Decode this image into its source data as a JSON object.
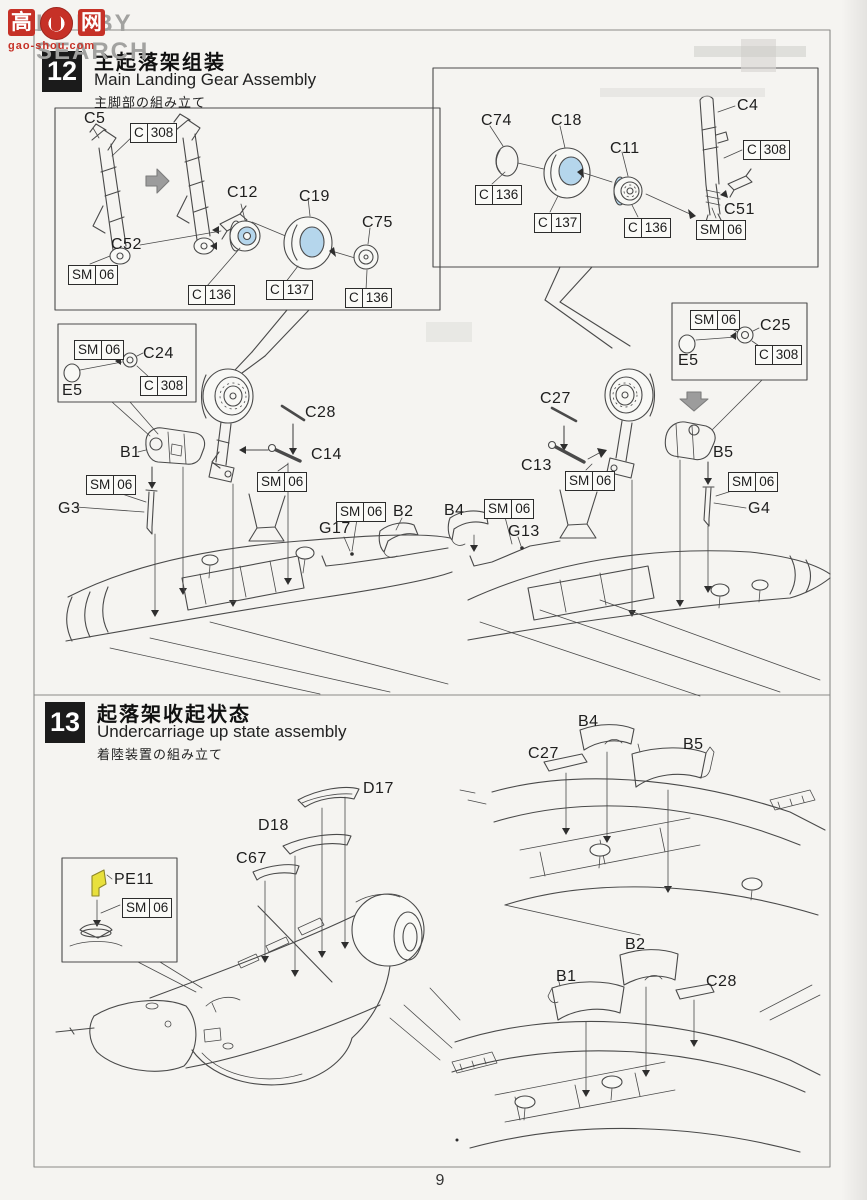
{
  "watermark": {
    "logo_left": "高",
    "logo_right": "网",
    "brand": "HOBBY SEARCH",
    "site": "gao-shou.com"
  },
  "page": {
    "number": "9"
  },
  "colors": {
    "highlight_blue": "#b5d6ec",
    "pe_yellow": "#e8e03c",
    "step_box_black": "#1b1b1b",
    "watermark_red": "#c63127",
    "line_gray": "#4a4a4a"
  },
  "steps": {
    "s12": {
      "number": "12",
      "title_cn": "主起落架组装",
      "title_en": "Main Landing Gear Assembly",
      "title_jp": "主脚部の組み立て"
    },
    "s13": {
      "number": "13",
      "title_cn": "起落架收起状态",
      "title_en": "Undercarriage up state assembly",
      "title_jp": "着陸装置の組み立て"
    }
  },
  "parts": {
    "b1": "B1",
    "b2": "B2",
    "b4": "B4",
    "b5": "B5",
    "c4": "C4",
    "c5": "C5",
    "c11": "C11",
    "c12": "C12",
    "c13": "C13",
    "c14": "C14",
    "c18": "C18",
    "c19": "C19",
    "c24": "C24",
    "c25": "C25",
    "c27": "C27",
    "c28": "C28",
    "c51": "C51",
    "c52": "C52",
    "c67": "C67",
    "c74": "C74",
    "c75": "C75",
    "d17": "D17",
    "d18": "D18",
    "e5": "E5",
    "g3": "G3",
    "g4": "G4",
    "g13": "G13",
    "g17": "G17",
    "pe11": "PE11"
  },
  "callouts": {
    "c136": {
      "p": "C",
      "n": "136"
    },
    "c137": {
      "p": "C",
      "n": "137"
    },
    "c308": {
      "p": "C",
      "n": "308"
    },
    "sm06": {
      "p": "SM",
      "n": "06"
    }
  }
}
